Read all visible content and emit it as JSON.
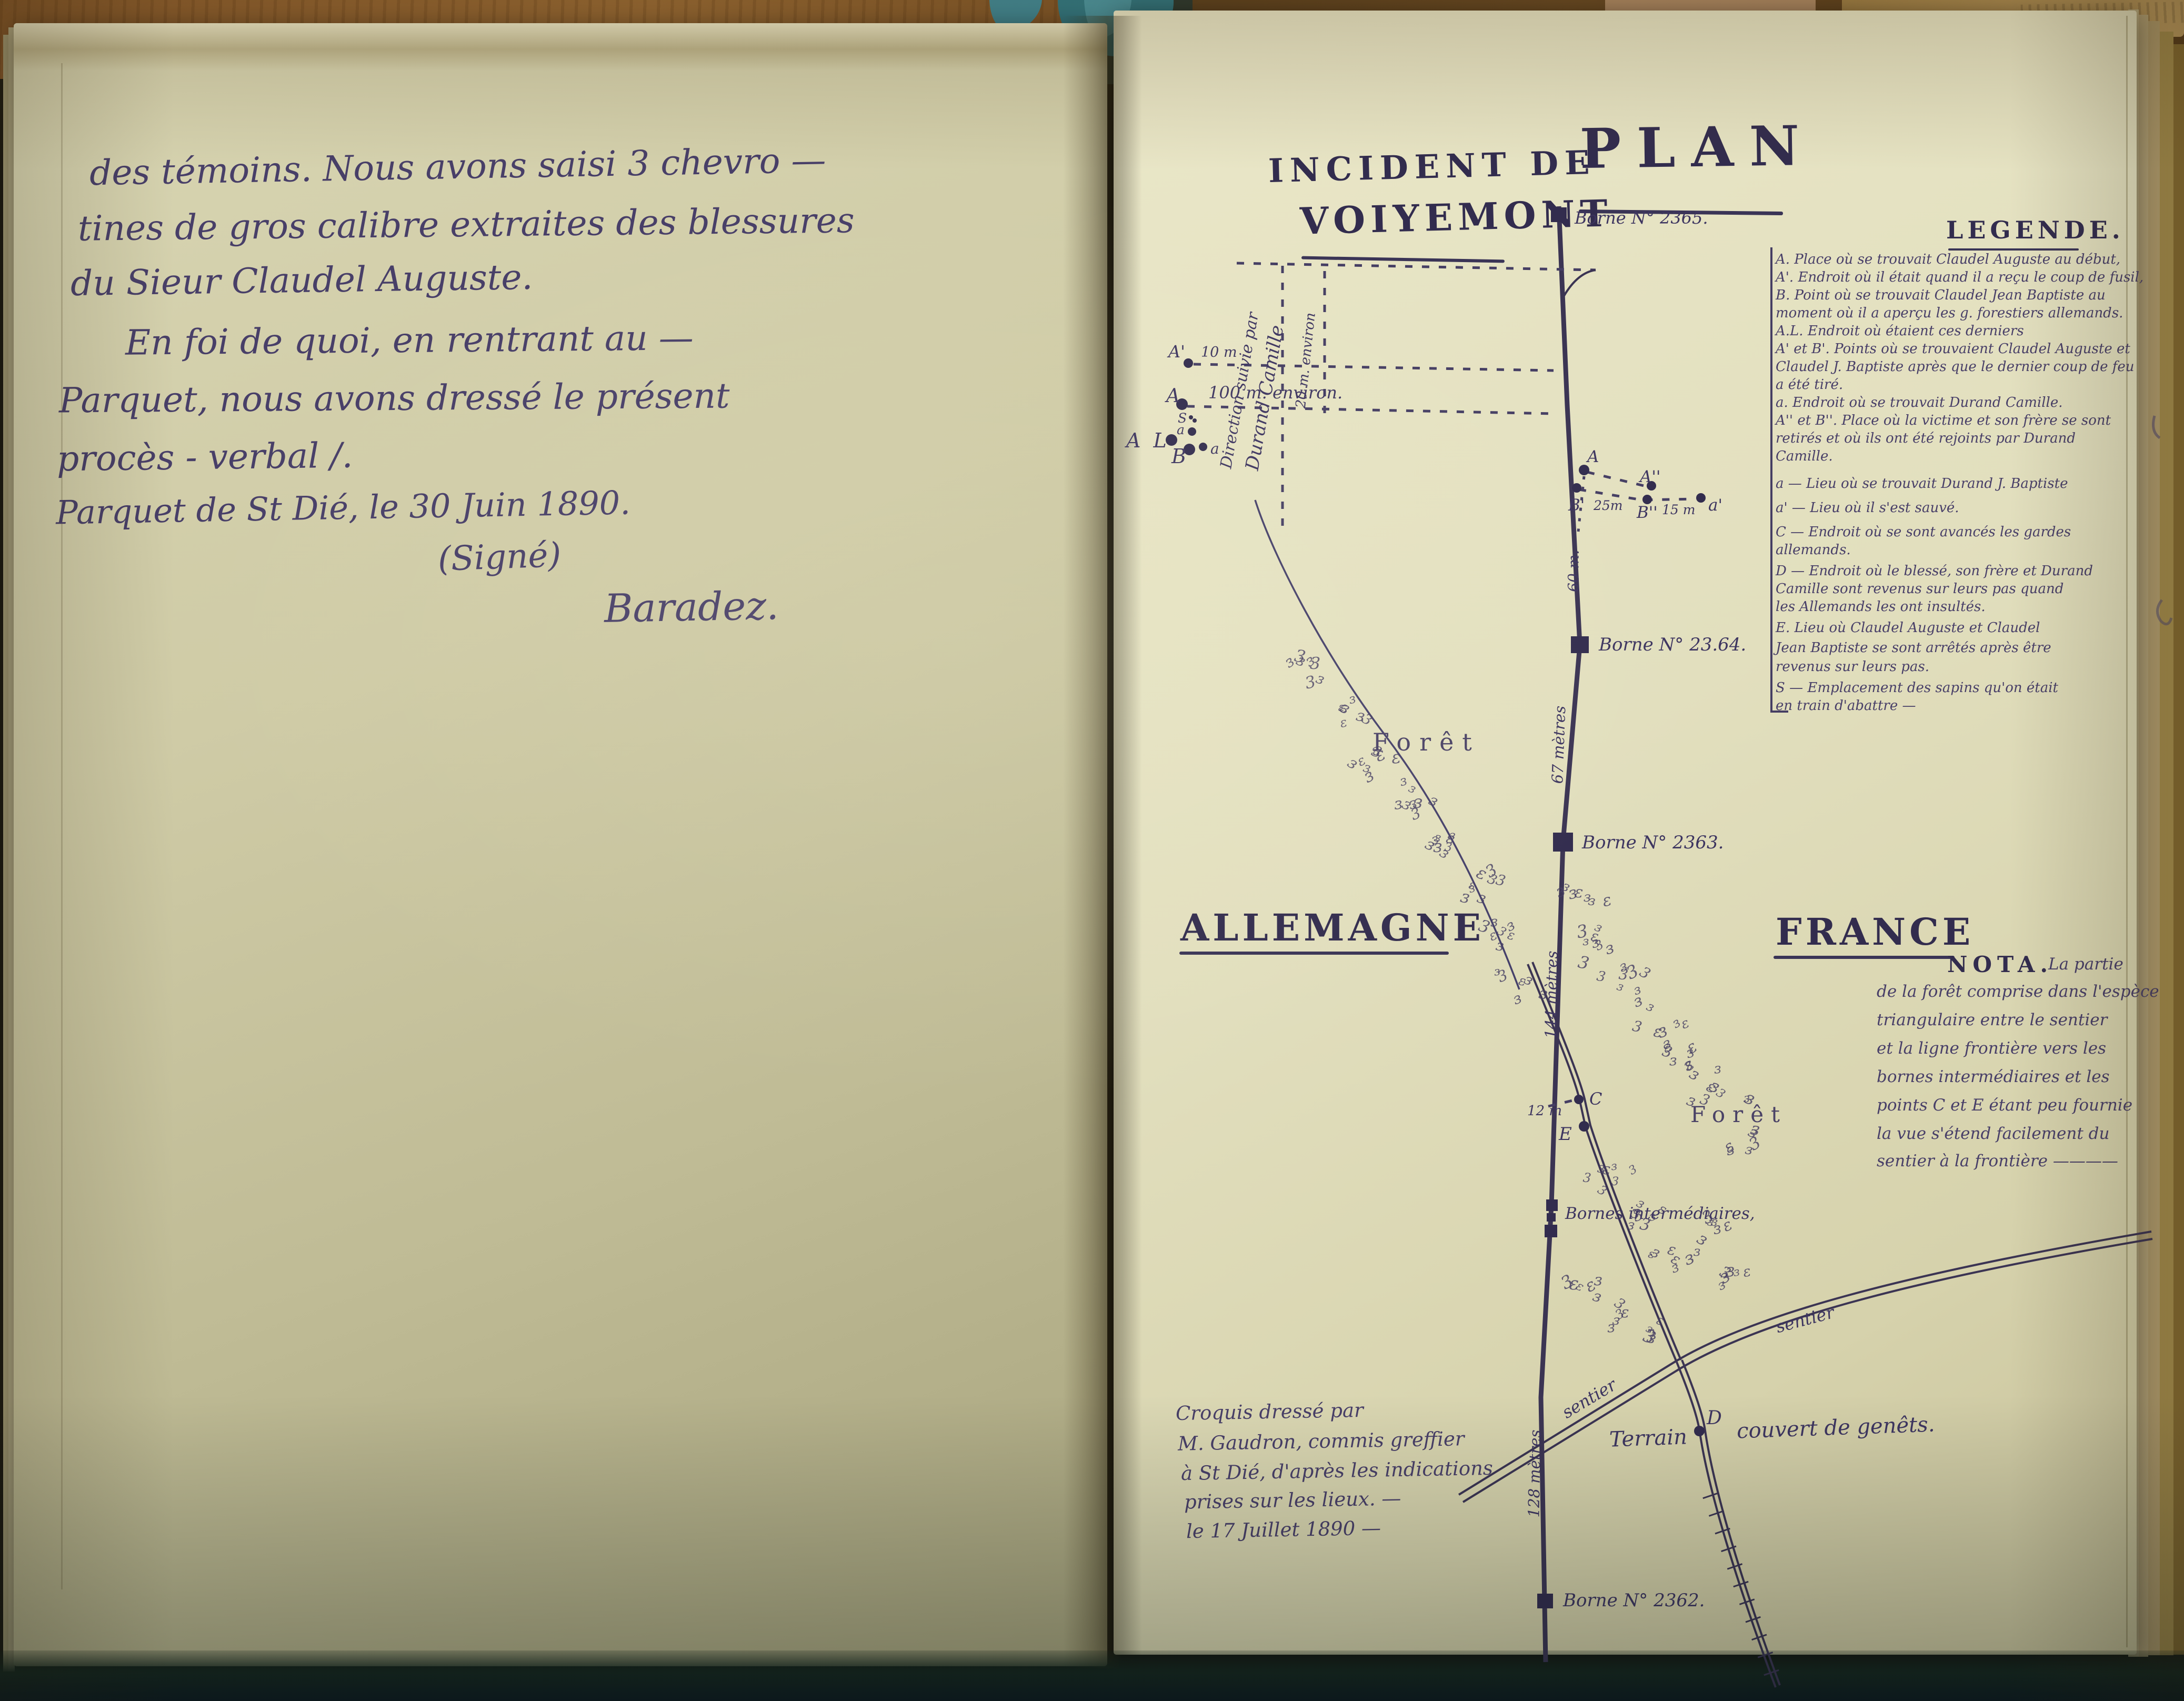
{
  "left_page": {
    "lines": [
      "des témoins. Nous avons saisi 3 chevro —",
      "tines de gros calibre extraites des blessures",
      "du Sieur Claudel Auguste.",
      "En foi de quoi, en rentrant au —",
      "Parquet, nous avons dressé le présent",
      "procès - verbal /.",
      "Parquet de St Dié, le 30 Juin 1890.",
      "(Signé)",
      "Baradez."
    ]
  },
  "right_page": {
    "title": "PLAN",
    "subtitle_line1": "INCIDENT DE",
    "subtitle_line2": "VOIYEMONT",
    "countries": {
      "left": "ALLEMAGNE",
      "right": "FRANCE"
    },
    "legend": {
      "title": "LEGENDE.",
      "lines": [
        "A. Place où se trouvait Claudel Auguste au début,",
        "A'. Endroit où il était quand il a reçu le coup de fusil,",
        "B. Point où se trouvait Claudel Jean Baptiste au",
        "moment où il a aperçu les g. forestiers allemands.",
        "A.L. Endroit où étaient ces derniers",
        "A' et B'. Points où se trouvaient Claudel Auguste et",
        "Claudel J. Baptiste après que le dernier coup de feu",
        "a été tiré.",
        "a. Endroit où se trouvait Durand Camille.",
        "A'' et B''. Place où la victime et son frère se sont",
        "retirés et où ils ont été rejoints par Durand",
        "Camille.",
        "a — Lieu où se trouvait Durand J. Baptiste",
        "a' — Lieu où il s'est sauvé.",
        "C — Endroit où se sont avancés les gardes",
        "allemands.",
        "D — Endroit où le blessé, son frère et Durand",
        "Camille sont revenus sur leurs pas quand",
        "les Allemands les ont insultés.",
        "E. Lieu où Claudel Auguste et Claudel",
        "Jean Baptiste se sont arrêtés après être",
        "revenus sur leurs pas.",
        "S — Emplacement des sapins qu'on était",
        "en train d'abattre —"
      ]
    },
    "nota": {
      "label": "NOTA.",
      "lines": [
        "La partie",
        "de la forêt comprise dans l'espèce",
        "triangulaire entre le sentier",
        "et la ligne frontière vers les",
        "bornes intermédiaires et les",
        "points C et E étant peu fournie",
        "la vue s'étend facilement du",
        "sentier à la frontière ————"
      ]
    },
    "bornes": {
      "b2365": "Borne N° 2365.",
      "b2364": "Borne N° 23.64.",
      "b2363": "Borne N° 2363.",
      "intermediaires": "Bornes intermédiaires,",
      "b2362": "Borne N° 2362."
    },
    "distances": {
      "d10": "10 m",
      "d100": "100 m. environ.",
      "d20": "20 m. environ",
      "d25": "25m",
      "d15": "15 m",
      "d12": "12 m",
      "d60": "60 m.",
      "d67": "67 mètres",
      "d144": "144 mètres",
      "d128": "128 mètres"
    },
    "direction_note": {
      "line1": "Direction suivie par",
      "line2": "Durand Camille"
    },
    "points": {
      "a_prime": "A'",
      "a_cap": "A",
      "s": "S",
      "a_small": "a",
      "al": "A L",
      "b": "B",
      "a_small2": "a",
      "a_line": "A",
      "a_dbl": "A''",
      "b_prime": "B'",
      "b_dbl": "B''",
      "a_escape": "a'",
      "c": "C",
      "e": "E",
      "d": "D"
    },
    "forest_label_1": "Forêt",
    "forest_label_2": "Forêt",
    "sentier_label_1": "sentier",
    "sentier_label_2": "sentier",
    "terrain": {
      "part1": "Terrain",
      "part2": "couvert de genêts."
    },
    "caption": {
      "lines": [
        "Croquis dressé par",
        "M. Gaudron, commis greffier",
        "à St Dié, d'après les indications",
        "prises sur les lieux. —",
        "le 17 Juillet 1890 —"
      ]
    }
  },
  "colors": {
    "ink": "#483f68",
    "printed_ink": "#322c4e",
    "paper_left": "#cdc9a4",
    "paper_right": "#e2dfbe",
    "ribbon": "#3f8fa0",
    "wood": "#8a5a2c"
  }
}
